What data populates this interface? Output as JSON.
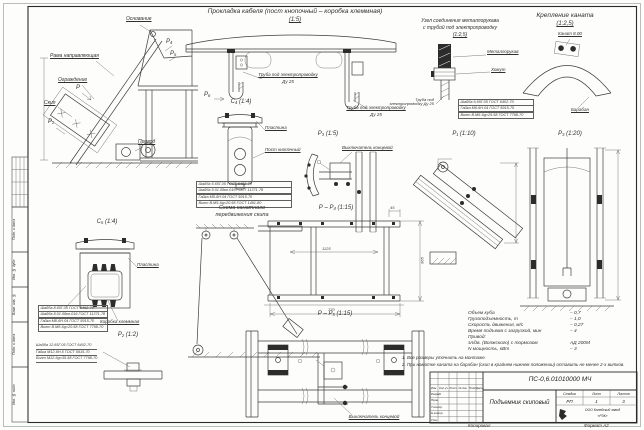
{
  "sheet": {
    "copied": "Копировал",
    "format": "Формат А2",
    "side_stamp": [
      "Подп. и дата",
      "Инв. № дубл.",
      "Взам. инв. №",
      "Подп. и дата",
      "Инв. № подл."
    ]
  },
  "main_view": {
    "labels": {
      "osnovanie": "Основание",
      "rama": "Рама направляющая",
      "ograzhdenie": "Ограждение",
      "skip": "Скип",
      "privod": "Привод"
    },
    "markers": {
      "p": "Р",
      "p1": "Р₁",
      "p4": "Р₄",
      "p5": "Р₅"
    }
  },
  "cable_view": {
    "title": "Прокладка кабеля (пост кнопочный – коробка клеммная)",
    "scale": "(1:5)",
    "tube1": "Труба под электропроводку",
    "tube1_dn": "Ду 25",
    "tube2": "Труба под электропроводку",
    "tube2_dn": "Ду 25",
    "marker_p6": "Р₆"
  },
  "node_view": {
    "title1": "Узел соединения металлорукава",
    "title2": "с трубой под электропроводку",
    "scale": "(1:2,5)",
    "metallorukav": "Металлорукав",
    "khomut": "Хомут",
    "truba": "Труба под электропроводку Ду 25",
    "table": [
      "Шайба 6.65Г.05 ГОСТ 6402-70",
      "Гайка М6-6Н.04 ГОСТ 5915-70",
      "Винт В.М6-6g×25.58 ГОСТ 7798-70"
    ]
  },
  "rope_view": {
    "title": "Крепление каната",
    "scale": "(1:2,5)",
    "kanat": "Канат 8.00",
    "baraban": "Барабан"
  },
  "c4_view": {
    "title": "С₄ (1:4)",
    "plastina": "Пластина",
    "post": "Пост кнопочный",
    "table": [
      "Шайба 5.65Г.05 ГОСТ 6402-70",
      "Шайба 5.01.08кп.016 ГОСТ 11371-78",
      "Гайка М5-6Н.04 ГОСТ 5915-70",
      "Винт В.М5-6g×20.58 ГОСТ 1491-80"
    ]
  },
  "c5_view": {
    "title": "С₅ (1:4)",
    "plastina": "Пластина",
    "korobka": "Коробка клеммная",
    "table": [
      "Шайба 8.65Г.05 ГОСТ 6402-70",
      "Шайба 8.01.08кп.016 ГОСТ 11371-78",
      "Гайка М8-6Н.04 ГОСТ 5915-70",
      "Винт В.М8-6g×20.58 ГОСТ 7798-70"
    ]
  },
  "p2_view": {
    "title": "Р₂ (1:2)",
    "callouts": [
      "Шайба 12.65Г.05 ГОСТ 6402-70",
      "Гайка М12-6Н.5 ГОСТ 5915-70",
      "Болт М12-6g×35.58 ГОСТ 7798-70"
    ]
  },
  "scheme_view": {
    "title1": "Схема канатного",
    "title2": "передвижения скипа"
  },
  "pp4_view": {
    "title": "Р – Р₄ (1:15)",
    "dims": {
      "center": "1125",
      "right": "965",
      "bottom": "770",
      "top": "45"
    }
  },
  "pp5_view": {
    "title": "Р – Р₅ (1:15)",
    "switch": "Выключатель концевой"
  },
  "p3_5_view": {
    "title": "Р₃ (1:5)",
    "switch": "Выключатель концевой"
  },
  "p1_view": {
    "title": "Р₁ (1:10)"
  },
  "p3_20_view": {
    "title": "Р₃ (1:20)"
  },
  "specs": {
    "rows": [
      {
        "name": "Объем куба",
        "value": "– 0,7"
      },
      {
        "name": "Грузоподъемность, т",
        "value": "– 1,0"
      },
      {
        "name": "Скорость движения, м/с",
        "value": "– 0,27"
      },
      {
        "name": "Время подъема с загрузкой, мин",
        "value": "– 4"
      },
      {
        "name": "Привод:",
        "value": ""
      },
      {
        "name": "эл/дв. (Волжского) с тормозом",
        "value": "АД 200М"
      },
      {
        "name": "N мощность, кВт",
        "value": "– 3"
      }
    ]
  },
  "notes": [
    "1. Все размеры уточнить на монтаже.",
    "2. При намотке каната на барабан (скип в крайнем нижнем положении) оставить не менее 2-х витков."
  ],
  "titleblock": {
    "doc_number": "ПС-0,6.01010000 МЧ",
    "doc_title": "Подъемник скиповый",
    "header_cols": [
      "Изм.",
      "Кол.уч",
      "Лист",
      "№ док.",
      "Подп.",
      "Дата"
    ],
    "rows": [
      "Разраб.",
      "Пров.",
      "Т.контр.",
      "Н.контр.",
      "Утв."
    ],
    "stage_label": "Стадия",
    "sheet_label": "Лист",
    "sheets_label": "Листов",
    "stage": "РП",
    "sheet": "1",
    "sheets": "3",
    "company1": "ООО Копейский завод",
    "company2": "«РЗК»"
  }
}
